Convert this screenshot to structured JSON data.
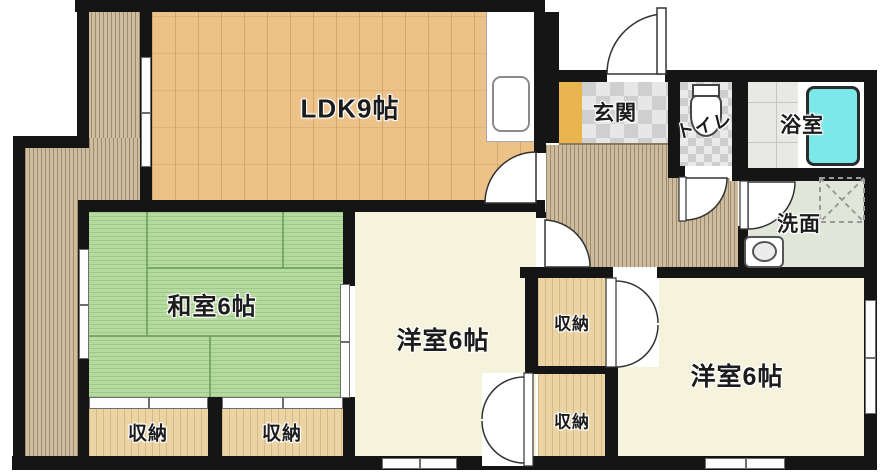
{
  "floorplan": {
    "type": "japanese-apartment-floorplan",
    "rooms": {
      "ldk": {
        "label": "LDK9帖"
      },
      "entrance": {
        "label": "玄関"
      },
      "toilet": {
        "label": "トイレ"
      },
      "bathroom": {
        "label": "浴室"
      },
      "washroom": {
        "label": "洗面"
      },
      "japanese_room": {
        "label": "和室6帖"
      },
      "western_room_center": {
        "label": "洋室6帖"
      },
      "western_room_right": {
        "label": "洋室6帖"
      },
      "storage_left_1": {
        "label": "収納"
      },
      "storage_left_2": {
        "label": "収納"
      },
      "storage_mid_top": {
        "label": "収納"
      },
      "storage_mid_bottom": {
        "label": "収納"
      }
    },
    "colors": {
      "wall": "#151515",
      "wood_floor": "#ecc289",
      "tatami": "#b6db9f",
      "deck_corridor": "#cdbd9e",
      "closet_wood": "#ebd3a4",
      "western_floor": "#f5f3dc",
      "washroom_floor": "#e0e7d9",
      "entrance_step": "#eab54e",
      "bathtub": "#7ce8ea"
    }
  }
}
